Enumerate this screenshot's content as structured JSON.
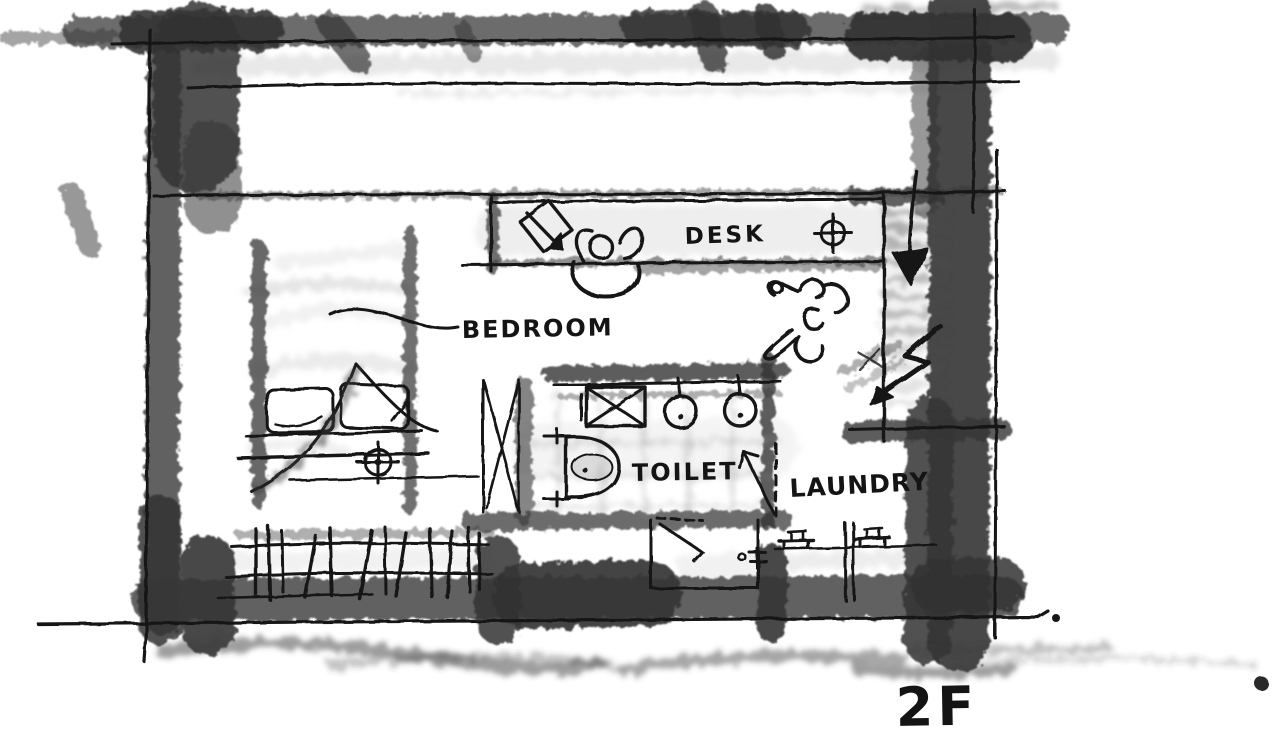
{
  "document": {
    "floor_label": "2F"
  },
  "rooms": {
    "bedroom": {
      "label": "BEDROOM"
    },
    "desk": {
      "label": "DESK"
    },
    "toilet": {
      "label": "TOILET"
    },
    "laundry": {
      "label": "LAUNDRY"
    }
  },
  "symbols": [
    "bed-icon",
    "pillow-icon",
    "ceiling-light-crosshair-icon",
    "monitor-arrow-icon",
    "person-at-desk-icon",
    "person-walking-icon",
    "stairs-down-arrow-icon",
    "toilet-bowl-icon",
    "sink-icon",
    "shelf-x-icon",
    "closet-x-icon",
    "washer-bracket-icon",
    "railing-tick-icon",
    "door-swing-icon"
  ],
  "colors": {
    "paper": "#ffffff",
    "ink": "#161616",
    "charcoal": "#343434",
    "shade": "#a9a9a9"
  }
}
